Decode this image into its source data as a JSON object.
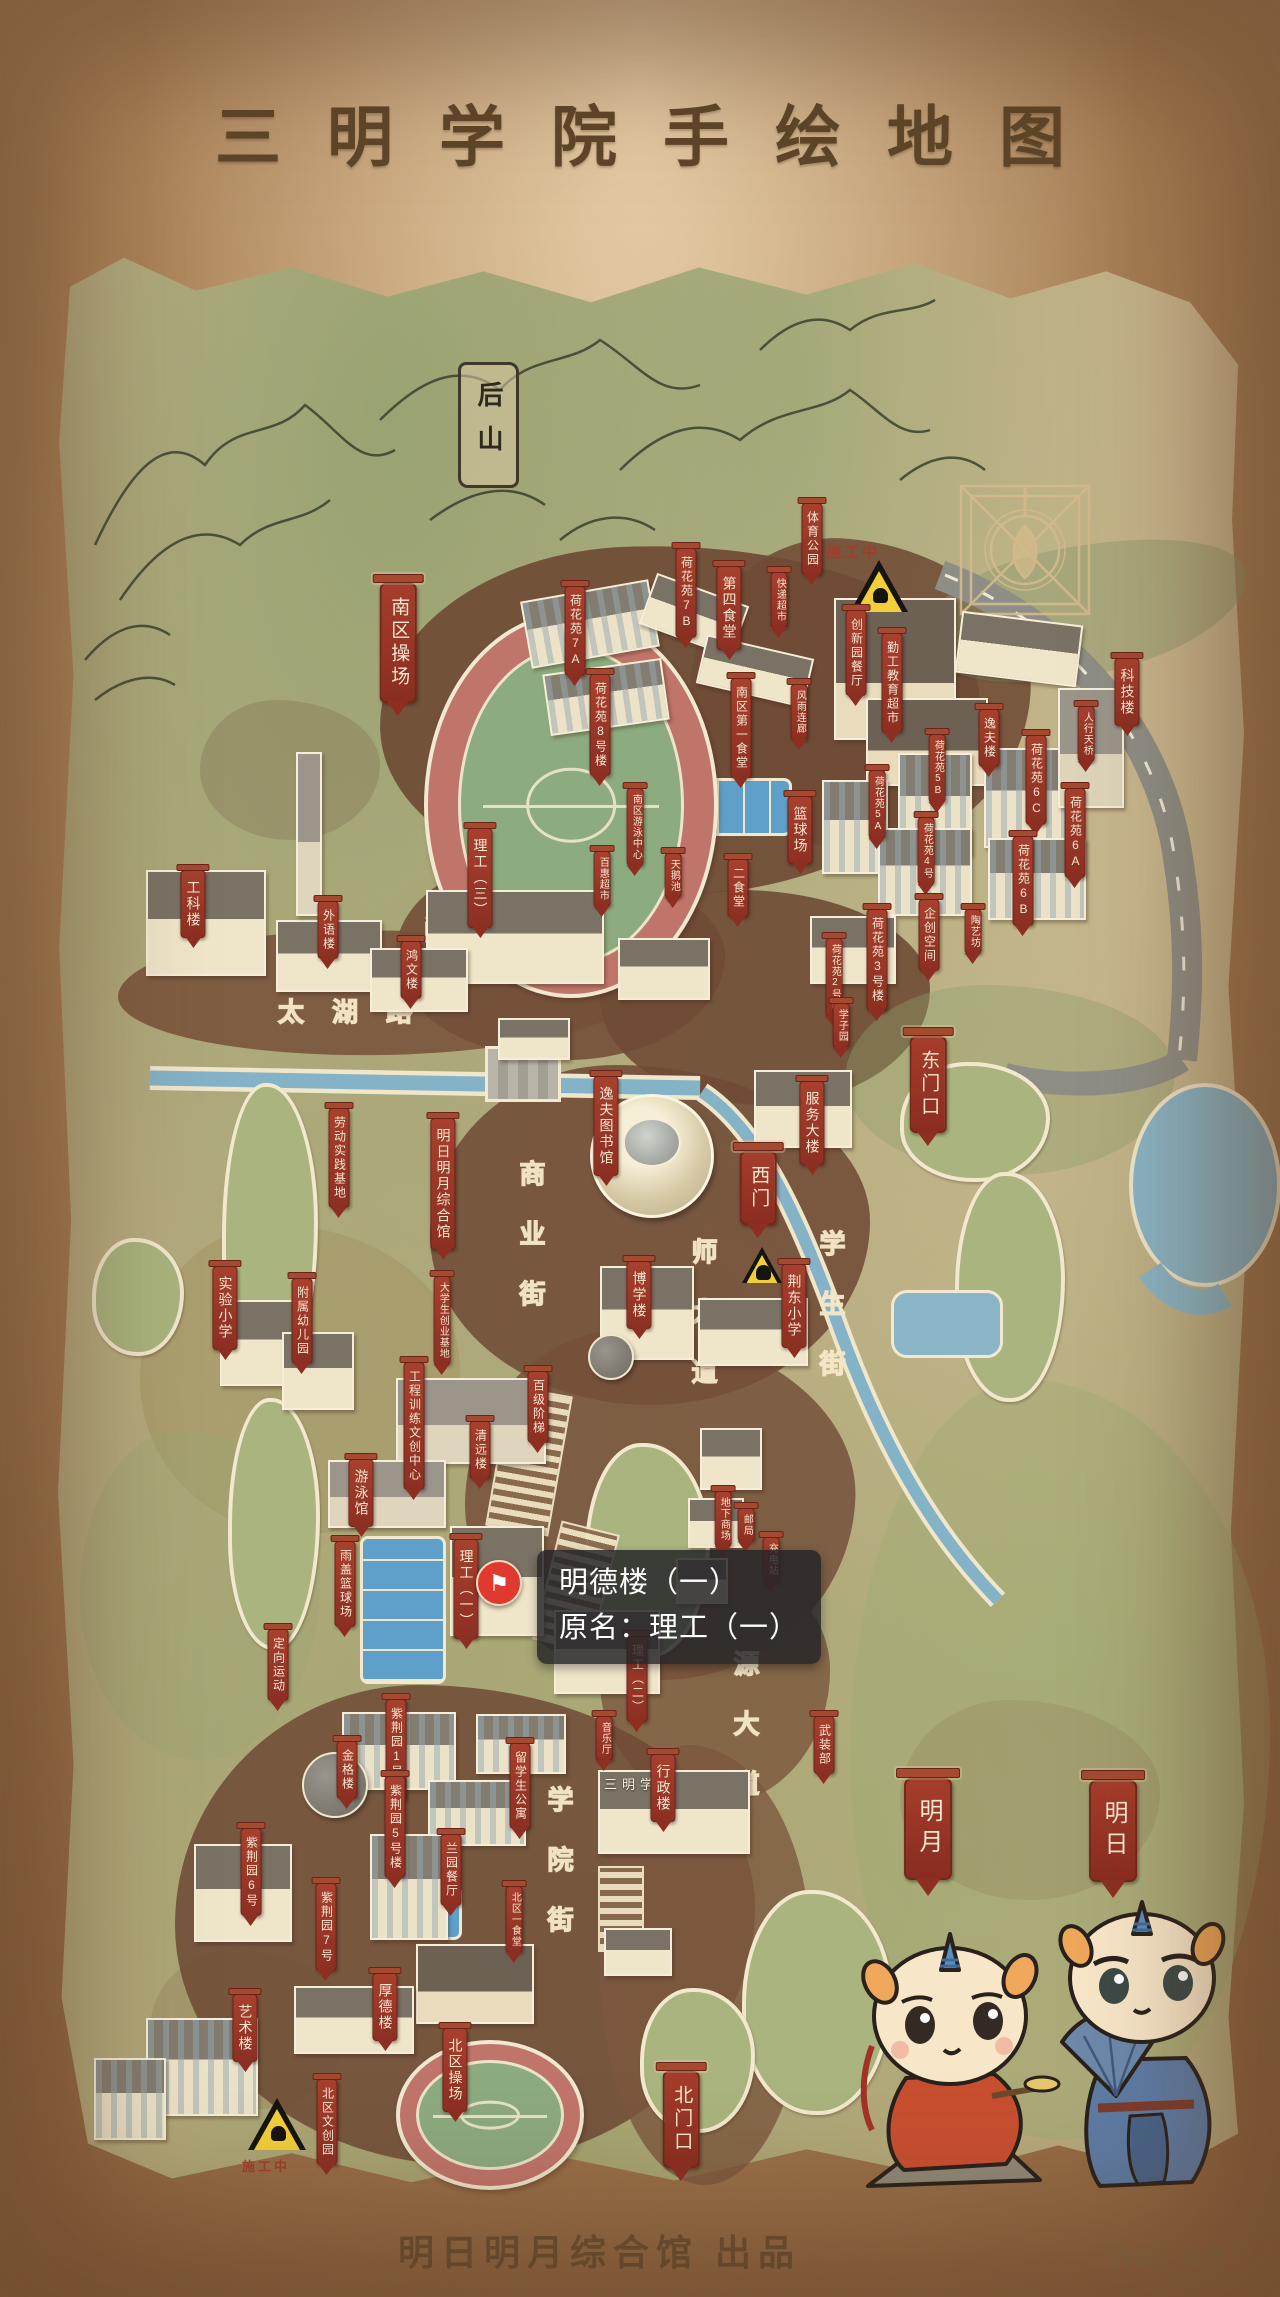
{
  "title": "三明学院手绘地图",
  "credits": {
    "producer": "明日明月综合馆 出品",
    "author": "作者：潘璐"
  },
  "tooltip": {
    "line1": "明德楼（一）",
    "line2": "原名：理工（一）",
    "pin_icon": "⚑"
  },
  "map_signs": {
    "back_hill": "后山",
    "gate_plaque": "三明学院",
    "construction": "施工中"
  },
  "road_labels": [
    {
      "id": "minjiang-road",
      "text": "闽江路",
      "x": 424,
      "y": 910,
      "dir": "h"
    },
    {
      "id": "taihu-road",
      "text": "太湖路",
      "x": 278,
      "y": 992,
      "dir": "h"
    },
    {
      "id": "shangye-street",
      "text": "商业街",
      "x": 512,
      "y": 1160,
      "dir": "v"
    },
    {
      "id": "shida-avenue",
      "text": "师大道",
      "x": 684,
      "y": 1238,
      "dir": "v"
    },
    {
      "id": "xuesheng-street",
      "text": "学生街",
      "x": 812,
      "y": 1230,
      "dir": "v"
    },
    {
      "id": "xueyuan-street",
      "text": "学院街",
      "x": 540,
      "y": 1786,
      "dir": "v"
    },
    {
      "id": "yuanda-avenue",
      "text": "源大道",
      "x": 726,
      "y": 1650,
      "dir": "v"
    }
  ],
  "labels": [
    {
      "id": "tiyu-gongyuan",
      "text": "体育公园",
      "x": 812,
      "y": 503,
      "c": "sm"
    },
    {
      "id": "nanqu-caochang",
      "text": "南区操场",
      "x": 398,
      "y": 583,
      "c": "lg"
    },
    {
      "id": "hehuayuan-7a",
      "text": "荷花苑7A",
      "x": 575,
      "y": 586,
      "c": "sm"
    },
    {
      "id": "hehuayuan-7b",
      "text": "荷花苑7B",
      "x": 686,
      "y": 548,
      "c": "sm"
    },
    {
      "id": "disi-shitang",
      "text": "第四食堂",
      "x": 729,
      "y": 566,
      "c": "md"
    },
    {
      "id": "kuaidi-chaoshi",
      "text": "快递超市",
      "x": 779,
      "y": 572,
      "c": "xs"
    },
    {
      "id": "chuangxinyuan-canting",
      "text": "创新园餐厅",
      "x": 856,
      "y": 610,
      "c": "sm"
    },
    {
      "id": "qingong-jiaoyu-chaoshi",
      "text": "勤工教育超市",
      "x": 892,
      "y": 633,
      "c": "sm"
    },
    {
      "id": "keji-lou",
      "text": "科技楼",
      "x": 1127,
      "y": 658,
      "c": "md"
    },
    {
      "id": "renxing-tianqiao",
      "text": "人行天桥",
      "x": 1086,
      "y": 706,
      "c": "xs"
    },
    {
      "id": "hehuayuan-8",
      "text": "荷花苑8号楼",
      "x": 600,
      "y": 674,
      "c": "sm"
    },
    {
      "id": "nanqu-diyi-shitang",
      "text": "南区第一食堂",
      "x": 741,
      "y": 678,
      "c": "sm"
    },
    {
      "id": "fengyu-lianlang",
      "text": "风雨连廊",
      "x": 799,
      "y": 684,
      "c": "xs"
    },
    {
      "id": "yifu-lou",
      "text": "逸夫楼",
      "x": 989,
      "y": 709,
      "c": "sm"
    },
    {
      "id": "hehuayuan-5b",
      "text": "荷花苑5B",
      "x": 937,
      "y": 734,
      "c": "xs"
    },
    {
      "id": "hehuayuan-6c",
      "text": "荷花苑6C",
      "x": 1036,
      "y": 735,
      "c": "sm"
    },
    {
      "id": "hehuayuan-5a",
      "text": "荷花苑5A",
      "x": 877,
      "y": 770,
      "c": "xs"
    },
    {
      "id": "hehuayuan-6a",
      "text": "荷花苑6A",
      "x": 1075,
      "y": 788,
      "c": "sm"
    },
    {
      "id": "hehuayuan-4",
      "text": "荷花苑4号",
      "x": 926,
      "y": 817,
      "c": "xs"
    },
    {
      "id": "hehuayuan-6b",
      "text": "荷花苑6B",
      "x": 1023,
      "y": 836,
      "c": "sm"
    },
    {
      "id": "nanqu-youyong-zhongxin",
      "text": "南区游泳中心",
      "x": 635,
      "y": 788,
      "c": "xs"
    },
    {
      "id": "lanqiu-chang",
      "text": "篮球场",
      "x": 800,
      "y": 796,
      "c": "md"
    },
    {
      "id": "ligong-3",
      "text": "理工（三）",
      "x": 480,
      "y": 828,
      "c": "md"
    },
    {
      "id": "baihui-chaoshi",
      "text": "百惠超市",
      "x": 602,
      "y": 851,
      "c": "xs"
    },
    {
      "id": "tiane-chi",
      "text": "天鹅池",
      "x": 673,
      "y": 853,
      "c": "xs"
    },
    {
      "id": "er-shitang",
      "text": "二食堂",
      "x": 738,
      "y": 859,
      "c": "sm"
    },
    {
      "id": "gongke-lou",
      "text": "工科楼",
      "x": 193,
      "y": 870,
      "c": "md"
    },
    {
      "id": "waiyu-lou",
      "text": "外语楼",
      "x": 328,
      "y": 901,
      "c": "sm"
    },
    {
      "id": "hongwen-lou",
      "text": "鸿文楼",
      "x": 411,
      "y": 941,
      "c": "sm"
    },
    {
      "id": "hehuayuan-3",
      "text": "荷花苑3号楼",
      "x": 877,
      "y": 909,
      "c": "sm"
    },
    {
      "id": "qichuang-kongjian",
      "text": "企创空间",
      "x": 929,
      "y": 899,
      "c": "sm"
    },
    {
      "id": "taoyi-fang",
      "text": "陶艺坊",
      "x": 973,
      "y": 909,
      "c": "xs"
    },
    {
      "id": "hehuayuan-2",
      "text": "荷花苑2号楼",
      "x": 834,
      "y": 938,
      "c": "xs"
    },
    {
      "id": "xuezi-yuan",
      "text": "学子园",
      "x": 841,
      "y": 1003,
      "c": "xs"
    },
    {
      "id": "dong-menkou",
      "text": "东门口",
      "x": 928,
      "y": 1036,
      "c": "lg"
    },
    {
      "id": "fuwu-dalou",
      "text": "服务大楼",
      "x": 812,
      "y": 1081,
      "c": "md"
    },
    {
      "id": "yifu-tushuguan",
      "text": "逸夫图书馆",
      "x": 606,
      "y": 1076,
      "c": "md"
    },
    {
      "id": "laodong-shijian-jidi",
      "text": "劳动实践基地",
      "x": 339,
      "y": 1108,
      "c": "sm"
    },
    {
      "id": "mingri-mingyue-zongheguan",
      "text": "明日明月综合馆",
      "x": 443,
      "y": 1118,
      "c": "md"
    },
    {
      "id": "xi-men",
      "text": "西门",
      "x": 758,
      "y": 1151,
      "c": "lg"
    },
    {
      "id": "boxue-lou",
      "text": "博学楼",
      "x": 639,
      "y": 1261,
      "c": "md"
    },
    {
      "id": "jingdong-xiaoxue",
      "text": "荆东小学",
      "x": 794,
      "y": 1264,
      "c": "md"
    },
    {
      "id": "daxuesheng-chuangye-jidi",
      "text": "大学生创业基地",
      "x": 442,
      "y": 1276,
      "c": "xs"
    },
    {
      "id": "shiyan-xiaoxue",
      "text": "实验小学",
      "x": 225,
      "y": 1266,
      "c": "md"
    },
    {
      "id": "fushu-youeryuan",
      "text": "附属幼儿园",
      "x": 302,
      "y": 1278,
      "c": "sm"
    },
    {
      "id": "gongcheng-xunlian-wenchuang-zhongxin",
      "text": "工程训练文创中心",
      "x": 414,
      "y": 1362,
      "c": "sm"
    },
    {
      "id": "baiji-jieti",
      "text": "百级阶梯",
      "x": 538,
      "y": 1371,
      "c": "sm"
    },
    {
      "id": "qingyuan-lou",
      "text": "清远楼",
      "x": 480,
      "y": 1421,
      "c": "sm"
    },
    {
      "id": "youyong-guan",
      "text": "游泳馆",
      "x": 361,
      "y": 1459,
      "c": "md"
    },
    {
      "id": "yugai-lanqiuchang",
      "text": "雨盖篮球场",
      "x": 345,
      "y": 1541,
      "c": "sm"
    },
    {
      "id": "ligong-1",
      "text": "理工（一）",
      "x": 466,
      "y": 1539,
      "c": "md"
    },
    {
      "id": "dingxiang-yundong",
      "text": "定向运动",
      "x": 278,
      "y": 1629,
      "c": "sm"
    },
    {
      "id": "ligong-2",
      "text": "理工（二）",
      "x": 637,
      "y": 1636,
      "c": "sm"
    },
    {
      "id": "dixia-shangchang",
      "text": "地下商场",
      "x": 723,
      "y": 1491,
      "c": "xs"
    },
    {
      "id": "youju",
      "text": "邮局",
      "x": 746,
      "y": 1508,
      "c": "xs"
    },
    {
      "id": "chongdian-zhan",
      "text": "充电站",
      "x": 771,
      "y": 1537,
      "c": "xs"
    },
    {
      "id": "wuzhuang-bu",
      "text": "武装部",
      "x": 824,
      "y": 1716,
      "c": "sm"
    },
    {
      "id": "yinyue-ting",
      "text": "音乐厅",
      "x": 604,
      "y": 1716,
      "c": "xs"
    },
    {
      "id": "xingzheng-lou",
      "text": "行政楼",
      "x": 663,
      "y": 1754,
      "c": "md"
    },
    {
      "id": "zijingyuan-1",
      "text": "紫荆园1号楼",
      "x": 396,
      "y": 1699,
      "c": "sm"
    },
    {
      "id": "jinge-lou",
      "text": "金格楼",
      "x": 347,
      "y": 1741,
      "c": "sm"
    },
    {
      "id": "liuxuesheng-gongyu",
      "text": "留学生公寓",
      "x": 520,
      "y": 1743,
      "c": "sm"
    },
    {
      "id": "zijingyuan-5",
      "text": "紫荆园5号楼",
      "x": 395,
      "y": 1776,
      "c": "sm"
    },
    {
      "id": "zijingyuan-6",
      "text": "紫荆园6号",
      "x": 251,
      "y": 1828,
      "c": "sm"
    },
    {
      "id": "lanyuan-canting",
      "text": "兰园餐厅",
      "x": 451,
      "y": 1834,
      "c": "sm"
    },
    {
      "id": "zijingyuan-7",
      "text": "紫荆园7号",
      "x": 326,
      "y": 1883,
      "c": "sm"
    },
    {
      "id": "beiqu-yi-shitang",
      "text": "北区一食堂",
      "x": 514,
      "y": 1886,
      "c": "xs"
    },
    {
      "id": "houde-lou",
      "text": "厚德楼",
      "x": 385,
      "y": 1973,
      "c": "md"
    },
    {
      "id": "yishu-lou",
      "text": "艺术楼",
      "x": 245,
      "y": 1994,
      "c": "md"
    },
    {
      "id": "beiqu-caochang",
      "text": "北区操场",
      "x": 455,
      "y": 2028,
      "c": "md"
    },
    {
      "id": "beiqu-wenchuang-yuan",
      "text": "北区文创园",
      "x": 327,
      "y": 2079,
      "c": "sm"
    },
    {
      "id": "bei-menkou",
      "text": "北门口",
      "x": 681,
      "y": 2071,
      "c": "lg"
    },
    {
      "id": "mingyue",
      "text": "明月",
      "x": 928,
      "y": 1778,
      "c": "xl"
    },
    {
      "id": "mingri",
      "text": "明日",
      "x": 1113,
      "y": 1780,
      "c": "xl"
    }
  ]
}
